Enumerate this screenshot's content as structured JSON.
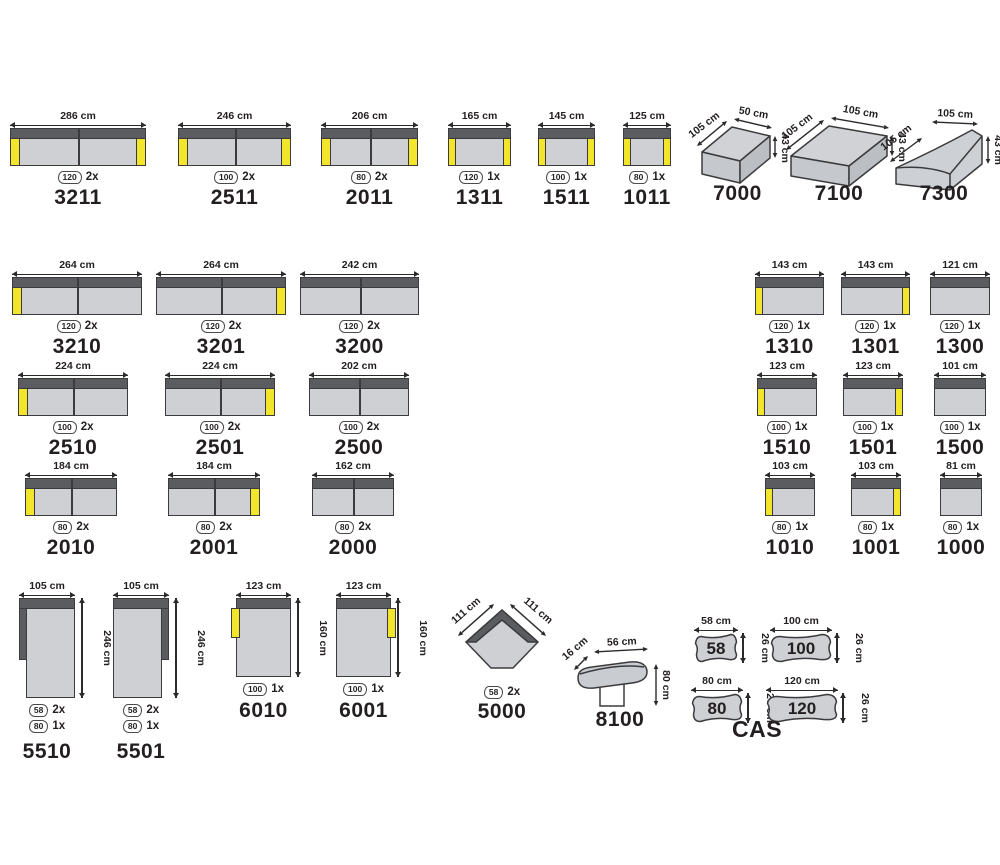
{
  "colors": {
    "yellow": "#f3e42c",
    "backrest_gray": "#5a5c60",
    "seat_gray": "#ced0d4",
    "outline": "#3b3b3d",
    "text": "#231f20"
  },
  "cas_label": "CAS",
  "modules": [
    {
      "id": "3211",
      "type": "sofa",
      "dim": "286 cm",
      "arms": "both",
      "seats": 2,
      "badges": [
        {
          "size": "120",
          "count": "2x"
        }
      ],
      "px": {
        "x": 10,
        "y": 128,
        "w": 136,
        "h": 38
      }
    },
    {
      "id": "2511",
      "type": "sofa",
      "dim": "246 cm",
      "arms": "both",
      "seats": 2,
      "badges": [
        {
          "size": "100",
          "count": "2x"
        }
      ],
      "px": {
        "x": 178,
        "y": 128,
        "w": 113,
        "h": 38
      }
    },
    {
      "id": "2011",
      "type": "sofa",
      "dim": "206 cm",
      "arms": "both",
      "seats": 2,
      "badges": [
        {
          "size": "80",
          "count": "2x"
        }
      ],
      "px": {
        "x": 321,
        "y": 128,
        "w": 97,
        "h": 38
      }
    },
    {
      "id": "1311",
      "type": "sofa",
      "dim": "165 cm",
      "arms": "both",
      "seats": 1,
      "badges": [
        {
          "size": "120",
          "count": "1x"
        }
      ],
      "px": {
        "x": 448,
        "y": 128,
        "w": 63,
        "h": 38
      }
    },
    {
      "id": "1511",
      "type": "sofa",
      "dim": "145 cm",
      "arms": "both",
      "seats": 1,
      "badges": [
        {
          "size": "100",
          "count": "1x"
        }
      ],
      "px": {
        "x": 538,
        "y": 128,
        "w": 57,
        "h": 38
      }
    },
    {
      "id": "1011",
      "type": "sofa",
      "dim": "125 cm",
      "arms": "both",
      "seats": 1,
      "badges": [
        {
          "size": "80",
          "count": "1x"
        }
      ],
      "px": {
        "x": 623,
        "y": 128,
        "w": 48,
        "h": 38
      }
    },
    {
      "id": "7000",
      "type": "box3d",
      "dim_depth": "105 cm",
      "dim_width": "50 cm",
      "dim_height": "43 cm",
      "px": {
        "x": 690,
        "y": 110,
        "w": 95,
        "h": 78
      }
    },
    {
      "id": "7100",
      "type": "box3d",
      "dim_depth": "105 cm",
      "dim_width": "105 cm",
      "dim_height": "43 cm",
      "wide": true,
      "px": {
        "x": 783,
        "y": 110,
        "w": 112,
        "h": 78
      }
    },
    {
      "id": "7300",
      "type": "wedge3d",
      "dim_depth": "105 cm",
      "dim_width": "105 cm",
      "dim_height": "43 cm",
      "px": {
        "x": 888,
        "y": 110,
        "w": 112,
        "h": 78
      }
    },
    {
      "id": "3210",
      "type": "sofa",
      "dim": "264 cm",
      "arms": "left",
      "seats": 2,
      "badges": [
        {
          "size": "120",
          "count": "2x"
        }
      ],
      "px": {
        "x": 12,
        "y": 277,
        "w": 130,
        "h": 38
      }
    },
    {
      "id": "3201",
      "type": "sofa",
      "dim": "264 cm",
      "arms": "right",
      "seats": 2,
      "badges": [
        {
          "size": "120",
          "count": "2x"
        }
      ],
      "px": {
        "x": 156,
        "y": 277,
        "w": 130,
        "h": 38
      }
    },
    {
      "id": "3200",
      "type": "sofa",
      "dim": "242 cm",
      "arms": "none",
      "seats": 2,
      "badges": [
        {
          "size": "120",
          "count": "2x"
        }
      ],
      "px": {
        "x": 300,
        "y": 277,
        "w": 119,
        "h": 38
      }
    },
    {
      "id": "1310",
      "type": "sofa",
      "dim": "143 cm",
      "arms": "left",
      "seats": 1,
      "badges": [
        {
          "size": "120",
          "count": "1x"
        }
      ],
      "px": {
        "x": 755,
        "y": 277,
        "w": 69,
        "h": 38
      }
    },
    {
      "id": "1301",
      "type": "sofa",
      "dim": "143 cm",
      "arms": "right",
      "seats": 1,
      "badges": [
        {
          "size": "120",
          "count": "1x"
        }
      ],
      "px": {
        "x": 841,
        "y": 277,
        "w": 69,
        "h": 38
      }
    },
    {
      "id": "1300",
      "type": "sofa",
      "dim": "121 cm",
      "arms": "none",
      "seats": 1,
      "badges": [
        {
          "size": "120",
          "count": "1x"
        }
      ],
      "px": {
        "x": 930,
        "y": 277,
        "w": 60,
        "h": 38
      }
    },
    {
      "id": "2510",
      "type": "sofa",
      "dim": "224 cm",
      "arms": "left",
      "seats": 2,
      "badges": [
        {
          "size": "100",
          "count": "2x"
        }
      ],
      "px": {
        "x": 18,
        "y": 378,
        "w": 110,
        "h": 38
      }
    },
    {
      "id": "2501",
      "type": "sofa",
      "dim": "224 cm",
      "arms": "right",
      "seats": 2,
      "badges": [
        {
          "size": "100",
          "count": "2x"
        }
      ],
      "px": {
        "x": 165,
        "y": 378,
        "w": 110,
        "h": 38
      }
    },
    {
      "id": "2500",
      "type": "sofa",
      "dim": "202 cm",
      "arms": "none",
      "seats": 2,
      "badges": [
        {
          "size": "100",
          "count": "2x"
        }
      ],
      "px": {
        "x": 309,
        "y": 378,
        "w": 100,
        "h": 38
      }
    },
    {
      "id": "1510",
      "type": "sofa",
      "dim": "123 cm",
      "arms": "left",
      "seats": 1,
      "badges": [
        {
          "size": "100",
          "count": "1x"
        }
      ],
      "px": {
        "x": 757,
        "y": 378,
        "w": 60,
        "h": 38
      }
    },
    {
      "id": "1501",
      "type": "sofa",
      "dim": "123 cm",
      "arms": "right",
      "seats": 1,
      "badges": [
        {
          "size": "100",
          "count": "1x"
        }
      ],
      "px": {
        "x": 843,
        "y": 378,
        "w": 60,
        "h": 38
      }
    },
    {
      "id": "1500",
      "type": "sofa",
      "dim": "101 cm",
      "arms": "none",
      "seats": 1,
      "badges": [
        {
          "size": "100",
          "count": "1x"
        }
      ],
      "px": {
        "x": 934,
        "y": 378,
        "w": 52,
        "h": 38
      }
    },
    {
      "id": "2010",
      "type": "sofa",
      "dim": "184 cm",
      "arms": "left",
      "seats": 2,
      "badges": [
        {
          "size": "80",
          "count": "2x"
        }
      ],
      "px": {
        "x": 25,
        "y": 478,
        "w": 92,
        "h": 38
      }
    },
    {
      "id": "2001",
      "type": "sofa",
      "dim": "184 cm",
      "arms": "right",
      "seats": 2,
      "badges": [
        {
          "size": "80",
          "count": "2x"
        }
      ],
      "px": {
        "x": 168,
        "y": 478,
        "w": 92,
        "h": 38
      }
    },
    {
      "id": "2000",
      "type": "sofa",
      "dim": "162 cm",
      "arms": "none",
      "seats": 2,
      "badges": [
        {
          "size": "80",
          "count": "2x"
        }
      ],
      "px": {
        "x": 312,
        "y": 478,
        "w": 82,
        "h": 38
      }
    },
    {
      "id": "1010",
      "type": "sofa",
      "dim": "103 cm",
      "arms": "left",
      "seats": 1,
      "badges": [
        {
          "size": "80",
          "count": "1x"
        }
      ],
      "px": {
        "x": 765,
        "y": 478,
        "w": 50,
        "h": 38
      }
    },
    {
      "id": "1001",
      "type": "sofa",
      "dim": "103 cm",
      "arms": "right",
      "seats": 1,
      "badges": [
        {
          "size": "80",
          "count": "1x"
        }
      ],
      "px": {
        "x": 851,
        "y": 478,
        "w": 50,
        "h": 38
      }
    },
    {
      "id": "1000",
      "type": "sofa",
      "dim": "81 cm",
      "arms": "none",
      "seats": 1,
      "badges": [
        {
          "size": "80",
          "count": "1x"
        }
      ],
      "px": {
        "x": 940,
        "y": 478,
        "w": 42,
        "h": 38
      }
    },
    {
      "id": "5510",
      "type": "chaise",
      "dim": "105 cm",
      "dim_v": "246 cm",
      "side": "left",
      "badges": [
        {
          "size": "58",
          "count": "2x"
        },
        {
          "size": "80",
          "count": "1x"
        }
      ],
      "px": {
        "x": 19,
        "y": 598,
        "w": 56,
        "h": 100
      }
    },
    {
      "id": "5501",
      "type": "chaise",
      "dim": "105 cm",
      "dim_v": "246 cm",
      "side": "right",
      "badges": [
        {
          "size": "58",
          "count": "2x"
        },
        {
          "size": "80",
          "count": "1x"
        }
      ],
      "px": {
        "x": 113,
        "y": 598,
        "w": 56,
        "h": 100
      }
    },
    {
      "id": "6010",
      "type": "vsofa",
      "dim": "123 cm",
      "dim_v": "160 cm",
      "side": "left",
      "badges": [
        {
          "size": "100",
          "count": "1x"
        }
      ],
      "px": {
        "x": 236,
        "y": 598,
        "w": 55,
        "h": 79
      }
    },
    {
      "id": "6001",
      "type": "vsofa",
      "dim": "123 cm",
      "dim_v": "160 cm",
      "side": "right",
      "badges": [
        {
          "size": "100",
          "count": "1x"
        }
      ],
      "px": {
        "x": 336,
        "y": 598,
        "w": 55,
        "h": 79
      }
    },
    {
      "id": "5000",
      "type": "corner",
      "dim_left": "111 cm",
      "dim_right": "111 cm",
      "badges": [
        {
          "size": "58",
          "count": "2x"
        }
      ],
      "px": {
        "x": 450,
        "y": 600,
        "w": 104,
        "h": 84
      }
    },
    {
      "id": "8100",
      "type": "headrest",
      "dim_depth": "16 cm",
      "dim_width": "56 cm",
      "dim_height": "80 cm",
      "px": {
        "x": 570,
        "y": 638,
        "w": 100,
        "h": 72
      }
    },
    {
      "id": "58",
      "type": "pillow",
      "dim": "58 cm",
      "dim_v": "26 cm",
      "px": {
        "x": 694,
        "y": 633,
        "w": 44,
        "h": 30
      }
    },
    {
      "id": "100",
      "type": "pillow",
      "dim": "100 cm",
      "dim_v": "26 cm",
      "px": {
        "x": 770,
        "y": 633,
        "w": 62,
        "h": 30
      }
    },
    {
      "id": "80",
      "type": "pillow",
      "dim": "80 cm",
      "dim_v": "26 cm",
      "px": {
        "x": 691,
        "y": 693,
        "w": 52,
        "h": 30
      }
    },
    {
      "id": "120",
      "type": "pillow",
      "dim": "120 cm",
      "dim_v": "26 cm",
      "px": {
        "x": 766,
        "y": 693,
        "w": 72,
        "h": 30
      }
    },
    {
      "id": "CAS",
      "type": "text",
      "px": {
        "x": 712,
        "y": 716,
        "w": 90,
        "h": 30
      }
    }
  ]
}
